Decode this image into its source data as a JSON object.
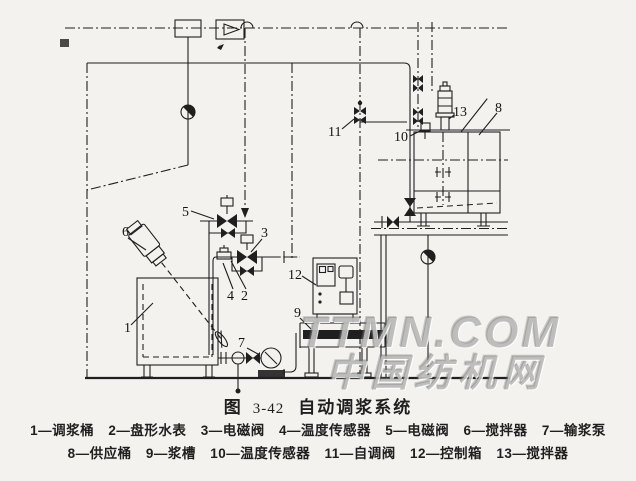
{
  "figure_caption": {
    "prefix": "图",
    "number": "3-42",
    "title": "自动调浆系统"
  },
  "watermark": {
    "line1": "TTMN.COM",
    "line2": "中国纺机网"
  },
  "legend": {
    "row1": [
      {
        "label": "1—调浆桶"
      },
      {
        "label": "2—盘形水表"
      },
      {
        "label": "3—电磁阀"
      },
      {
        "label": "4—温度传感器"
      },
      {
        "label": "5—电磁阀"
      },
      {
        "label": "6—搅拌器"
      },
      {
        "label": "7—输浆泵"
      }
    ],
    "row2": [
      {
        "label": "8—供应桶"
      },
      {
        "label": "9—浆槽"
      },
      {
        "label": "10—温度传感器"
      },
      {
        "label": "11—自调阀"
      },
      {
        "label": "12—控制箱"
      },
      {
        "label": "13—搅拌器"
      }
    ]
  },
  "part_labels": [
    "1",
    "2",
    "3",
    "4",
    "5",
    "6",
    "7",
    "8",
    "9",
    "10",
    "11",
    "12",
    "13"
  ],
  "symbols": {
    "mixing-barrel": "tank with tilted agitator",
    "solenoid-valve": "bowtie valve with coil box",
    "pump": "circle on pedestal",
    "water-meter": "half-filled ball",
    "control-box": "panel with buttons",
    "supply-barrel": "tank with top motor agitator"
  },
  "colors": {
    "ink": "#1f1f1f",
    "paper": "#f4f2ee",
    "watermark": "#7d7d7d"
  }
}
